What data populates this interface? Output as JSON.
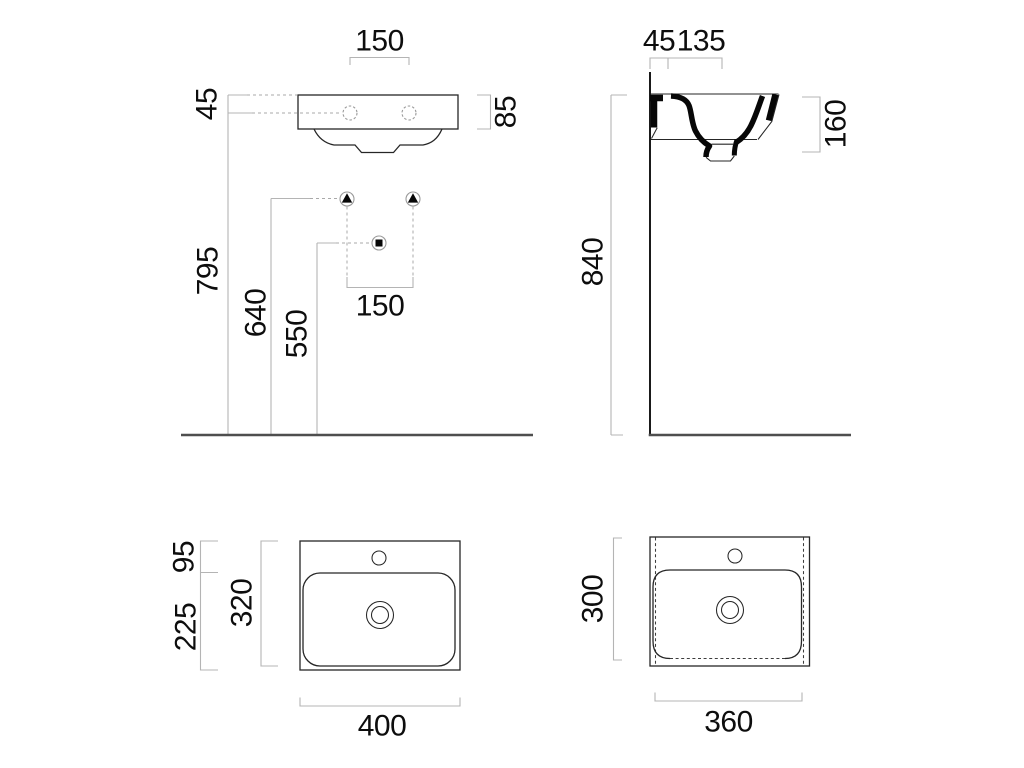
{
  "drawing": {
    "title": "wall-hung washbasin dimensional drawing",
    "units": "mm",
    "views": {
      "front": {
        "tap_hole_spacing": "150",
        "rim_to_tap_holes": "45",
        "rim_height": "85",
        "floor_to_tap_holes": "795",
        "floor_to_fixing_holes": "640",
        "floor_to_drain": "550",
        "fixing_hole_spacing": "150"
      },
      "side": {
        "wall_to_fixing": "45",
        "fixing_to_tap_hole": "135",
        "basin_section_height": "160",
        "floor_to_rim": "840"
      },
      "top": {
        "back_ledge_depth": "95",
        "bowl_to_front_depth": "225",
        "bowl_depth": "320",
        "overall_width": "400"
      },
      "bottom": {
        "base_depth": "300",
        "base_width": "360"
      }
    }
  }
}
